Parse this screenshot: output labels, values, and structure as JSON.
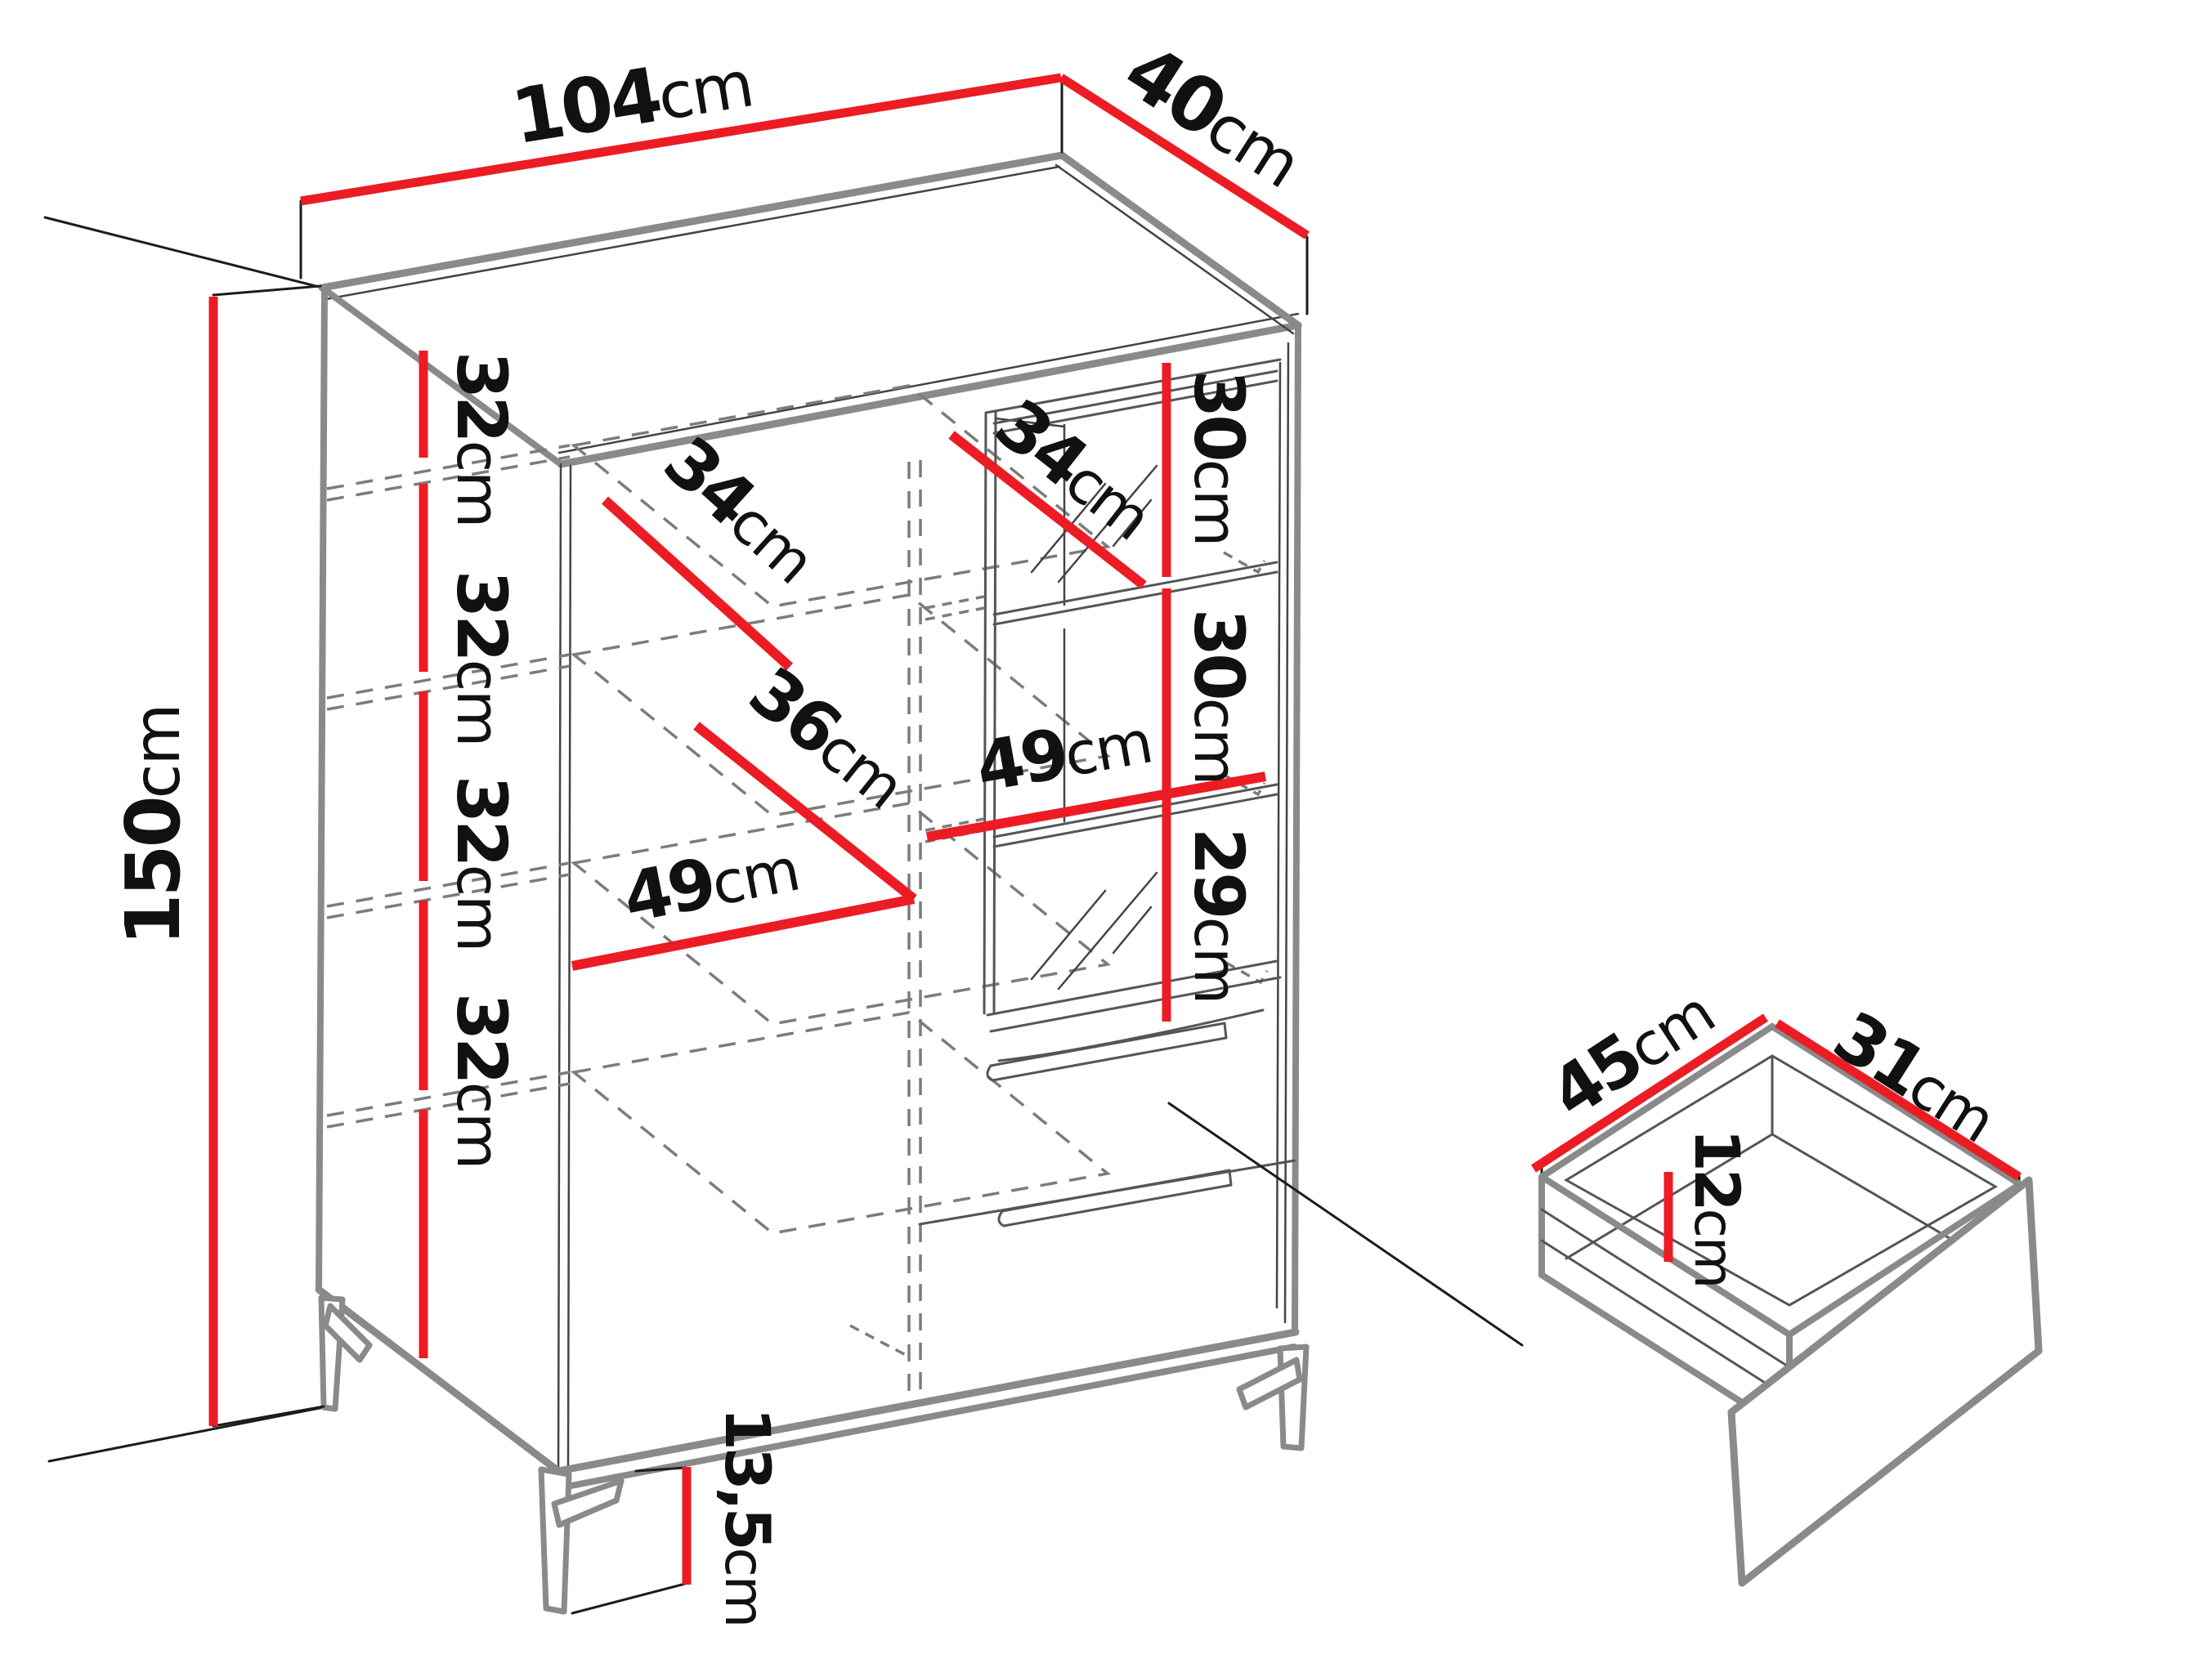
{
  "title": "Cabinet dimension diagram",
  "colors": {
    "accent_red": "#ec1c24",
    "line_gray": "#8a8a8a",
    "dash_gray": "#7c7c7c",
    "text_black": "#111111",
    "background": "#ffffff"
  },
  "cabinet": {
    "width": {
      "num": "104",
      "unit": "cm"
    },
    "depth": {
      "num": "40",
      "unit": "cm"
    },
    "height": {
      "num": "150",
      "unit": "cm"
    },
    "shelf_spacing": [
      {
        "num": "32",
        "unit": "cm"
      },
      {
        "num": "32",
        "unit": "cm"
      },
      {
        "num": "32",
        "unit": "cm"
      },
      {
        "num": "32",
        "unit": "cm"
      }
    ],
    "left_shelf_depth": {
      "num": "34",
      "unit": "cm"
    },
    "middle_shelf_depth": {
      "num": "36",
      "unit": "cm"
    },
    "left_compartment_width": {
      "num": "49",
      "unit": "cm"
    },
    "glass_shelf_depth": {
      "num": "34",
      "unit": "cm"
    },
    "glass_section_top": {
      "num": "30",
      "unit": "cm"
    },
    "glass_section_middle": {
      "num": "30",
      "unit": "cm"
    },
    "glass_section_bottom": {
      "num": "29",
      "unit": "cm"
    },
    "glass_compartment_width": {
      "num": "49",
      "unit": "cm"
    },
    "leg_height": {
      "num": "13,5",
      "unit": "cm"
    }
  },
  "drawer_detail": {
    "inner_width": {
      "num": "45",
      "unit": "cm"
    },
    "inner_depth": {
      "num": "31",
      "unit": "cm"
    },
    "inner_height": {
      "num": "12",
      "unit": "cm"
    }
  }
}
